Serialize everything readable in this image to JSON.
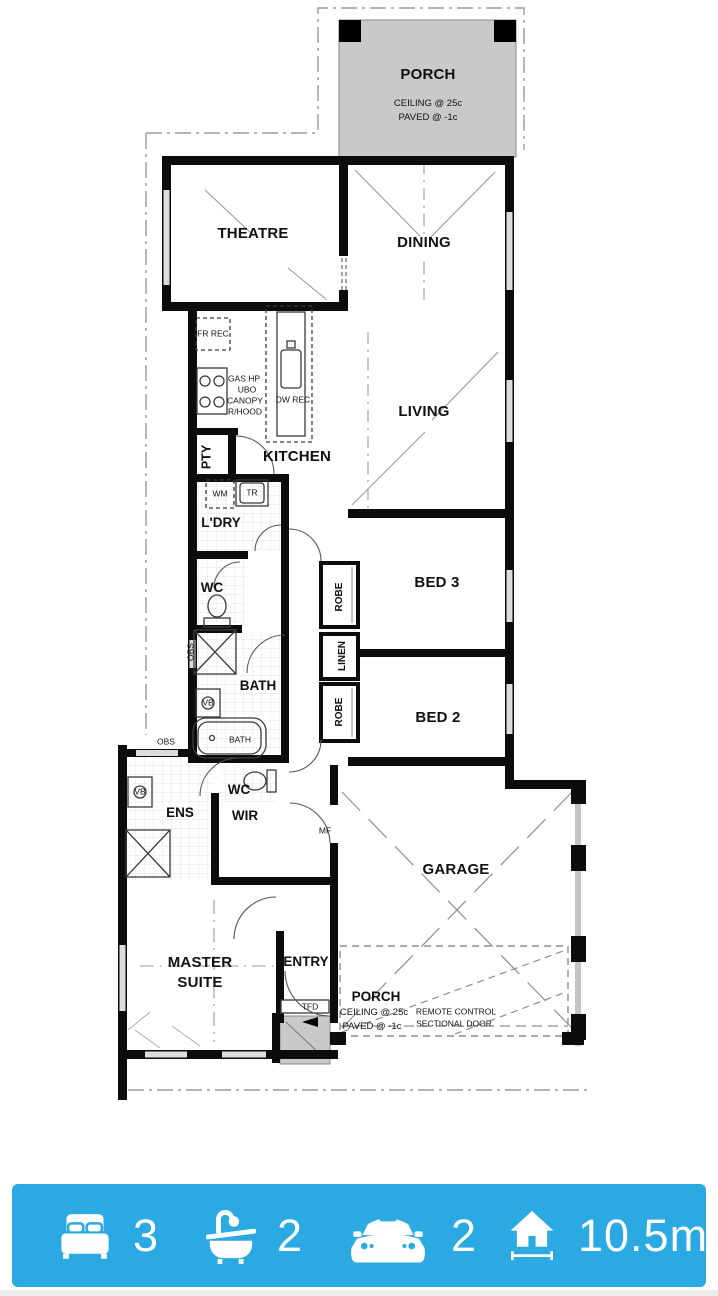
{
  "plan": {
    "porch_top": {
      "name": "PORCH",
      "ceiling": "CEILING @ 25c",
      "paved": "PAVED @ -1c"
    },
    "rooms": {
      "theatre": "THEATRE",
      "dining": "DINING",
      "living": "LIVING",
      "kitchen": "KITCHEN",
      "pantry": "PTY",
      "laundry": "L'DRY",
      "wc": "WC",
      "bath": "BATH",
      "bed3": "BED 3",
      "bed2": "BED 2",
      "robe_top": "ROBE",
      "linen": "LINEN",
      "robe_bottom": "ROBE",
      "ens": "ENS",
      "ens_wc": "WC",
      "wir": "WIR",
      "master": "MASTER SUITE",
      "entry": "ENTRY",
      "garage": "GARAGE"
    },
    "annotations": {
      "fr_rec": "FR REC",
      "gas_hp": "GAS HP",
      "ubo": "UBO",
      "canopy": "CANOPY",
      "rhood": "R/HOOD",
      "dw_rec": "DW REC",
      "wm": "WM",
      "tr": "TR",
      "vb_bath": "VB",
      "vb_ens": "VB",
      "bath_tub": "BATH",
      "obs_left": "OBS",
      "obs_bottom": "OBS",
      "mf": "MF",
      "tfd": "TFD"
    },
    "porch_bottom": {
      "name": "PORCH",
      "ceiling": "CEILING @ 25c",
      "paved": "PAVED @ -1c",
      "door_line1": "REMOTE CONTROL",
      "door_line2": "SECTIONAL DOOR"
    }
  },
  "summary_bar": {
    "background": "#2aa9e2",
    "items": [
      {
        "icon": "bed-icon",
        "value": "3"
      },
      {
        "icon": "bath-icon",
        "value": "2"
      },
      {
        "icon": "car-icon",
        "value": "2"
      },
      {
        "icon": "house-width-icon",
        "value": "10.5m"
      }
    ]
  }
}
